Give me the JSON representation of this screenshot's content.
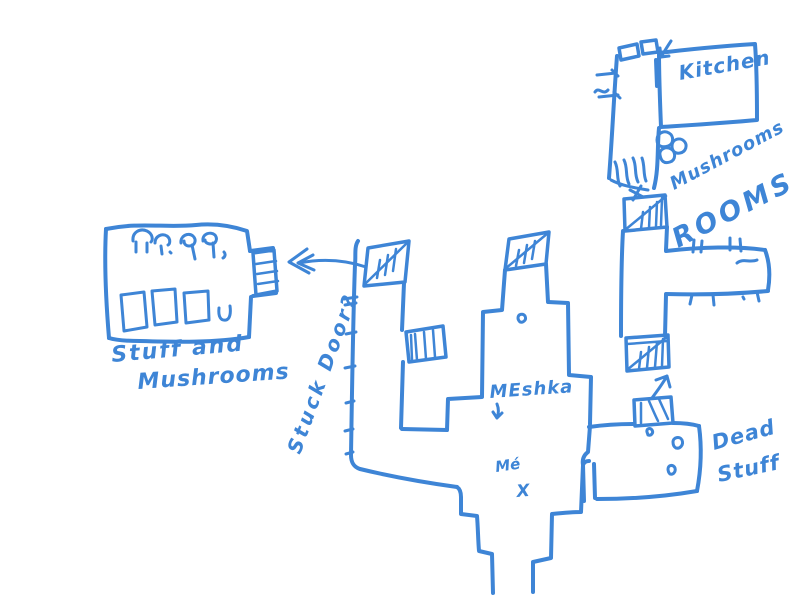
{
  "canvas": {
    "background": "#ffffff",
    "ink": "#3e85d6",
    "width": 800,
    "height": 600
  },
  "labels": {
    "kitchen": "Kitchen",
    "mushrooms": "Mushrooms",
    "rooms": "ROOMS",
    "stuff_and_mushrooms_line1": "Stuff and",
    "stuff_and_mushrooms_line2": "Mushrooms",
    "stuck_door": "Stuck Door?",
    "meshka": "MEshka",
    "me": "Mé",
    "me_marker": "X",
    "dead_stuff_line1": "Dead",
    "dead_stuff_line2": "Stuff"
  }
}
